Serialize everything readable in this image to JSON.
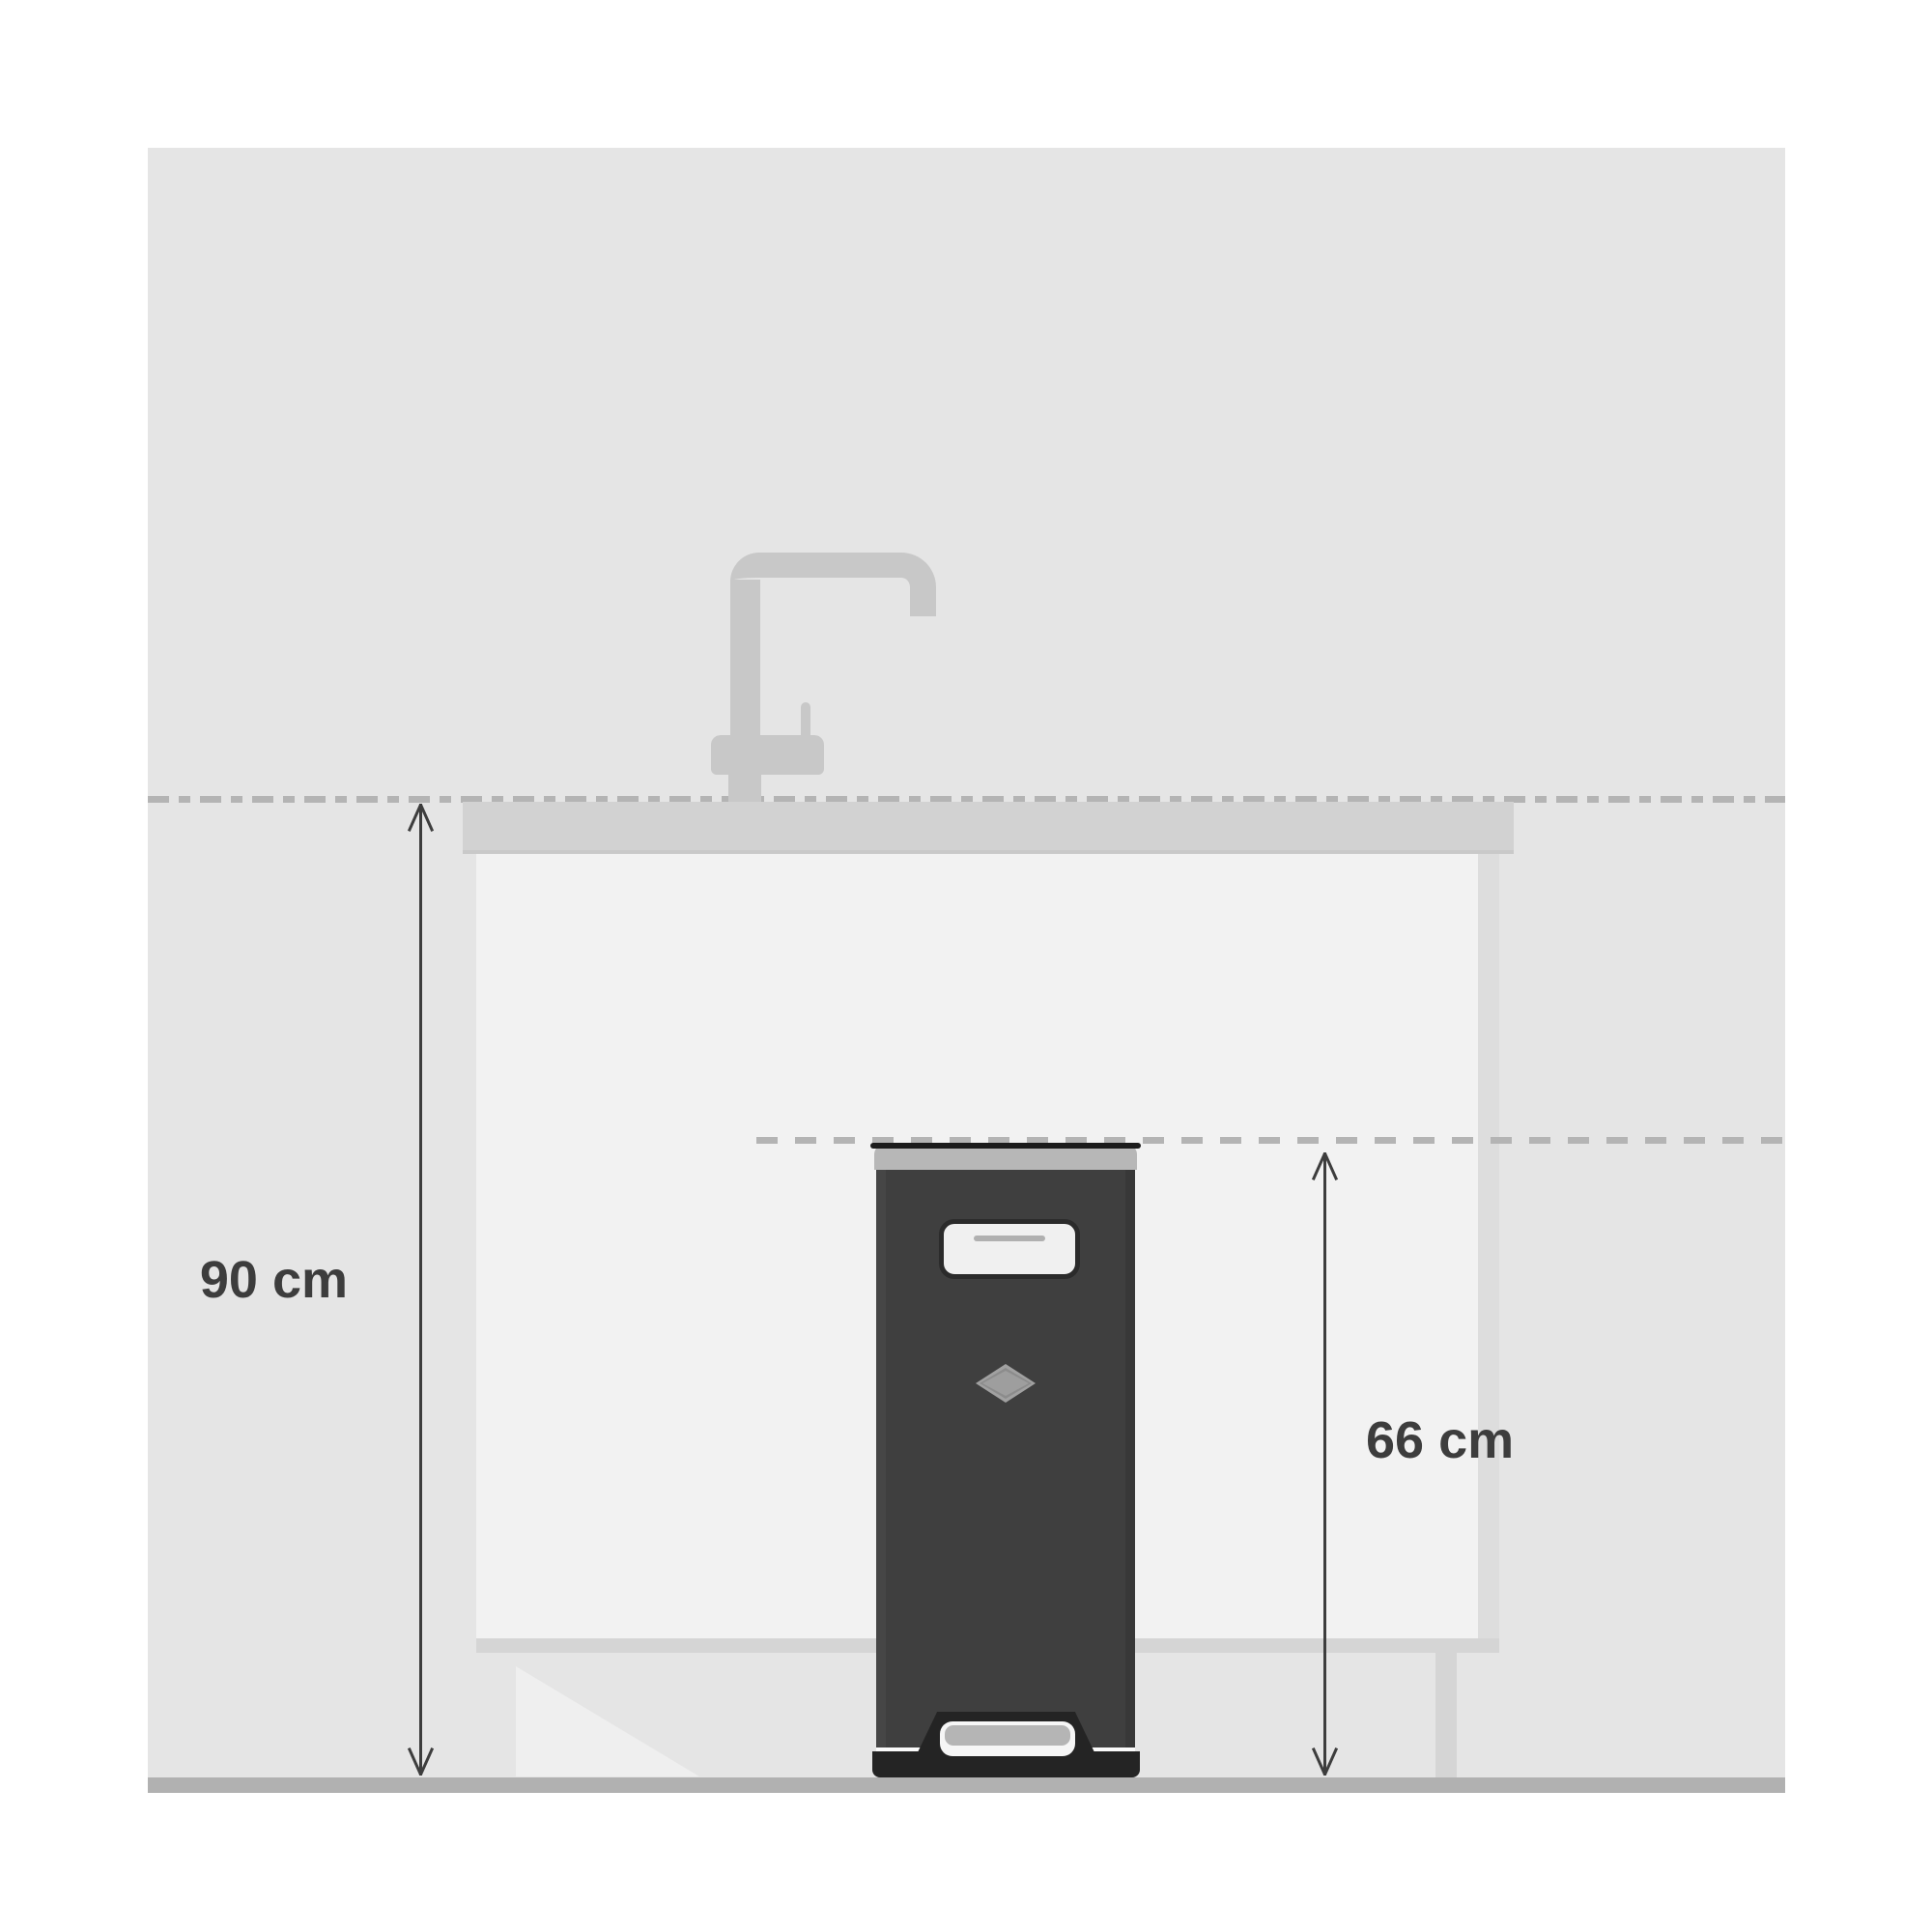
{
  "labels": {
    "counter_height": "90 cm",
    "bin_height": "66 cm"
  },
  "colors": {
    "wall": "#e5e5e5",
    "counter": "#d2d2d2",
    "counter_edge": "#c9c9c9",
    "cabinet": "#f2f2f2",
    "cabinet_shadow": "#d5d5d5",
    "toe_kick_highlight": "#efefef",
    "floor": "#b1b1b1",
    "faucet": "#c8c8c8",
    "dash_line": "#b4b4b4",
    "bin_body": "#3f3f3f",
    "bin_lid": "#b7b7b7",
    "bin_rim": "#1c1c1c",
    "pedal": "#242424",
    "plate_fill": "#f0f0f0",
    "plate_line": "#b0b0b0",
    "diamond": "#a1a1a1",
    "dimension": "#3d3d3d"
  }
}
